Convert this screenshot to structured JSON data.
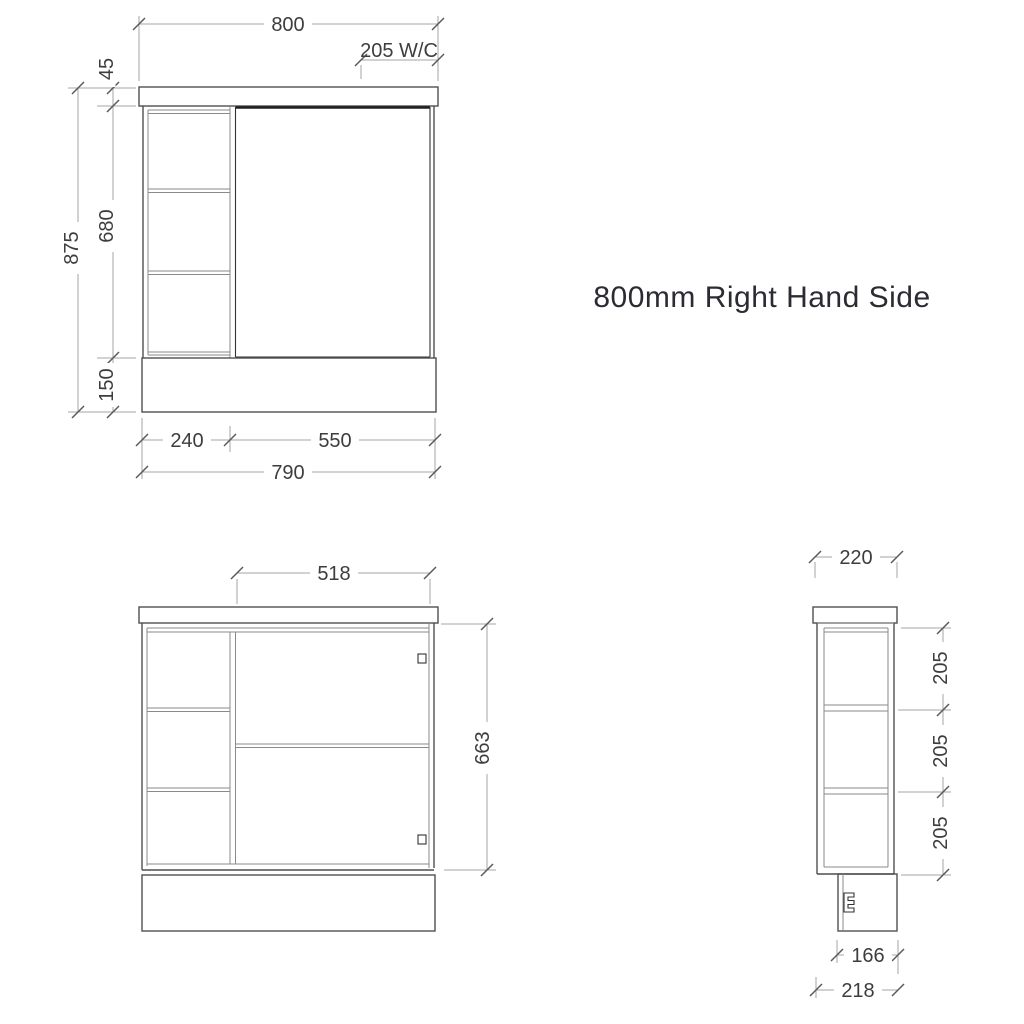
{
  "title": "800mm Right Hand Side",
  "colors": {
    "background": "#ffffff",
    "object_line": "#4f4f4f",
    "detail_line": "#8a8a8a",
    "door_edge_dark": "#1f1f1f",
    "dimension_line": "#a6a6a6",
    "tick": "#5a5a5a",
    "dimension_text": "#3d3d3d",
    "title_text": "#2b2b33"
  },
  "front_view": {
    "dims": {
      "top_width": "800",
      "wc_offset": "205 W/C",
      "benchtop_height": "45",
      "carcass_height": "680",
      "kickboard_height": "150",
      "overall_height": "875",
      "shelf_column_width": "240",
      "door_width": "550",
      "carcass_width": "790"
    }
  },
  "internal_view": {
    "dims": {
      "opening_width": "518",
      "internal_height": "663"
    }
  },
  "side_view": {
    "dims": {
      "depth": "220",
      "shelf_gap_top": "205",
      "shelf_gap_middle": "205",
      "shelf_gap_bottom": "205",
      "kickboard_recess_width": "166",
      "base_depth": "218"
    }
  }
}
